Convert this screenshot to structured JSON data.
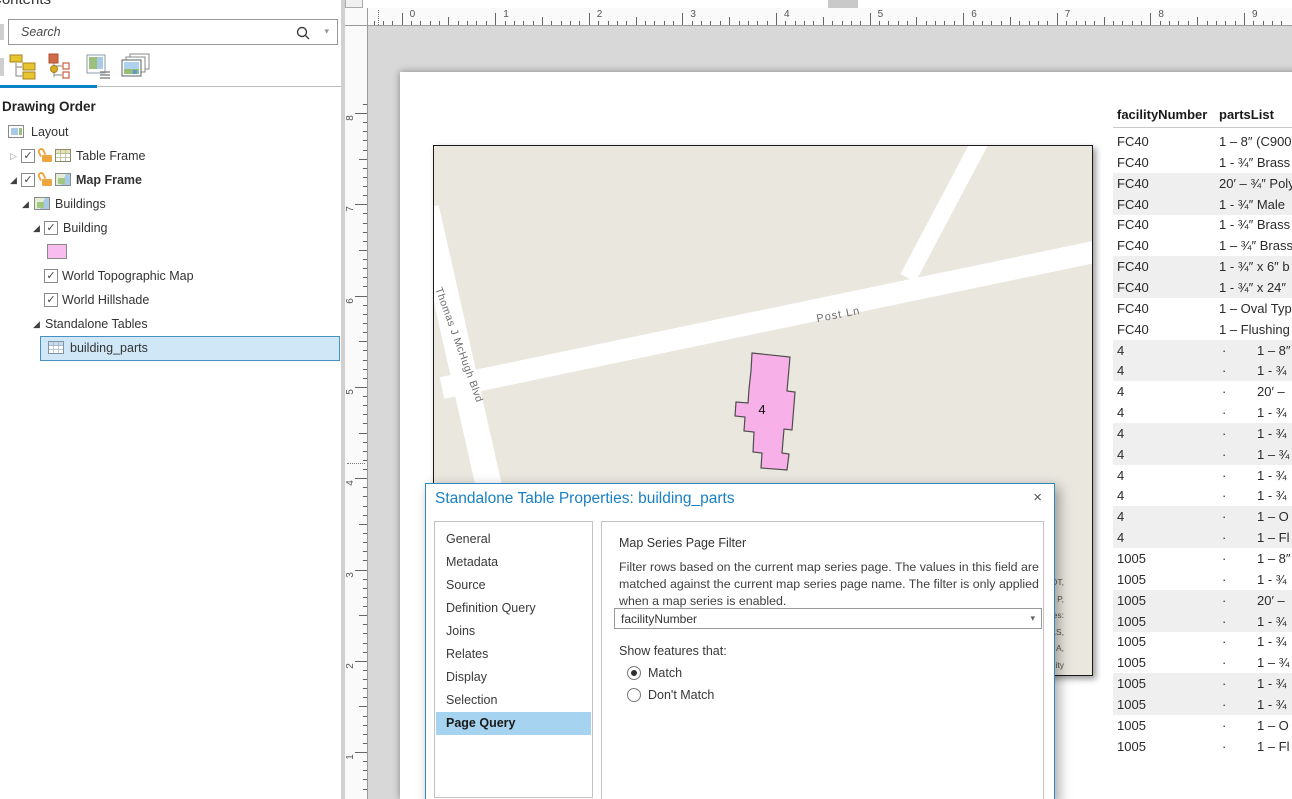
{
  "colors": {
    "accent_blue": "#0b82c8",
    "selection_fill": "#cfe7f7",
    "sidebar_selected": "#a6d3ef",
    "building_pink": "#f8b0e8",
    "swatch_pink": "#f9bcee",
    "map_background": "#e9e7de",
    "row_band": "#efefef"
  },
  "contents_panel": {
    "title": "Contents",
    "search": {
      "placeholder": "Search"
    },
    "section_heading": "Drawing Order",
    "toolbar_icons": [
      "list-by-drawing-order",
      "list-by-source",
      "list-by-selection",
      "list-by-snapping"
    ],
    "tree": [
      {
        "label": "Layout",
        "icon": "layout",
        "xi": 8,
        "xt": 31,
        "y": 121
      },
      {
        "label": "Table Frame",
        "expander": "collapsed",
        "xe": 10,
        "checkbox": true,
        "xc": 21,
        "lock": true,
        "xl": 42,
        "icon": "table-frame",
        "xi": 55,
        "xt": 76,
        "y": 145
      },
      {
        "label": "Map Frame",
        "bold": true,
        "expander": "expanded",
        "xe": 10,
        "checkbox": true,
        "xc": 21,
        "lock": true,
        "xl": 42,
        "icon": "map-frame",
        "xi": 55,
        "xt": 76,
        "y": 169
      },
      {
        "label": "Buildings",
        "expander": "expanded",
        "xe": 22,
        "icon": "map",
        "xi": 34,
        "xt": 55,
        "y": 193
      },
      {
        "label": "Building",
        "expander": "expanded",
        "xe": 33,
        "checkbox": true,
        "xc": 44,
        "xt": 63,
        "y": 217
      },
      {
        "swatch": true,
        "xs": 47,
        "y": 242
      },
      {
        "label": "World Topographic Map",
        "checkbox": true,
        "xc": 44,
        "xt": 62,
        "y": 265
      },
      {
        "label": "World Hillshade",
        "checkbox": true,
        "xc": 44,
        "xt": 62,
        "y": 289
      },
      {
        "label": "Standalone Tables",
        "expander": "expanded",
        "xe": 33,
        "xt": 45,
        "y": 313
      },
      {
        "label": "building_parts",
        "icon": "table",
        "xi": 48,
        "xt": 70,
        "y": 337,
        "selected": true
      }
    ]
  },
  "rulers": {
    "horizontal": [
      "0",
      "1",
      "2",
      "3",
      "4",
      "5",
      "6",
      "7",
      "8",
      "9"
    ],
    "vertical": [
      "8",
      "7",
      "6",
      "5",
      "4",
      "3",
      "2",
      "1"
    ]
  },
  "map": {
    "street_labels": [
      "Thomas J McHugh Blvd",
      "Post Ln"
    ],
    "building_label": "4",
    "attribution_fragments": [
      "OT,",
      "P,",
      "es:",
      "LS,",
      "A,",
      "ity"
    ]
  },
  "dialog": {
    "title": "Standalone Table Properties: building_parts",
    "close_glyph": "×",
    "sidebar_items": [
      "General",
      "Metadata",
      "Source",
      "Definition Query",
      "Joins",
      "Relates",
      "Display",
      "Selection",
      "Page Query"
    ],
    "selected_item": "Page Query",
    "content": {
      "heading": "Map Series Page Filter",
      "description_lines": [
        "Filter rows based on the current map series page. The values in this field are",
        "matched against the current map series page name. The filter is only applied",
        "when a map series is enabled."
      ],
      "dropdown_value": "facilityNumber",
      "dropdown_caret": "▾",
      "show_features_label": "Show features that:",
      "radio_options": [
        {
          "label": "Match",
          "selected": true
        },
        {
          "label": "Don't Match",
          "selected": false
        }
      ]
    }
  },
  "table": {
    "columns": [
      "facilityNumber",
      "partsList"
    ],
    "rows": [
      {
        "facility": "FC40",
        "dot": false,
        "part": "1 – 8″ (C900)"
      },
      {
        "facility": "FC40",
        "dot": false,
        "part": "1 - ¾″ Brass"
      },
      {
        "facility": "FC40",
        "dot": false,
        "part": "20′ – ¾″ Poly"
      },
      {
        "facility": "FC40",
        "dot": false,
        "part": "1 - ¾″ Male"
      },
      {
        "facility": "FC40",
        "dot": false,
        "part": "1 - ¾″ Brass"
      },
      {
        "facility": "FC40",
        "dot": false,
        "part": "1 – ¾″ Brass"
      },
      {
        "facility": "FC40",
        "dot": false,
        "part": "1 - ¾″ x 6″ b"
      },
      {
        "facility": "FC40",
        "dot": false,
        "part": "1 - ¾″ x 24″"
      },
      {
        "facility": "FC40",
        "dot": false,
        "part": "1 – Oval Type"
      },
      {
        "facility": "FC40",
        "dot": false,
        "part": "1 – Flushing"
      },
      {
        "facility": "4",
        "dot": true,
        "part": "1 – 8″"
      },
      {
        "facility": "4",
        "dot": true,
        "part": "1 - ¾"
      },
      {
        "facility": "4",
        "dot": true,
        "part": "20′ –"
      },
      {
        "facility": "4",
        "dot": true,
        "part": "1 - ¾"
      },
      {
        "facility": "4",
        "dot": true,
        "part": "1 - ¾"
      },
      {
        "facility": "4",
        "dot": true,
        "part": "1 – ¾"
      },
      {
        "facility": "4",
        "dot": true,
        "part": "1 - ¾"
      },
      {
        "facility": "4",
        "dot": true,
        "part": "1 - ¾"
      },
      {
        "facility": "4",
        "dot": true,
        "part": "1 – O"
      },
      {
        "facility": "4",
        "dot": true,
        "part": "1 – Fl"
      },
      {
        "facility": "1005",
        "dot": true,
        "part": "1 – 8″"
      },
      {
        "facility": "1005",
        "dot": true,
        "part": "1 - ¾"
      },
      {
        "facility": "1005",
        "dot": true,
        "part": "20′ –"
      },
      {
        "facility": "1005",
        "dot": true,
        "part": "1 - ¾"
      },
      {
        "facility": "1005",
        "dot": true,
        "part": "1 - ¾"
      },
      {
        "facility": "1005",
        "dot": true,
        "part": "1 – ¾"
      },
      {
        "facility": "1005",
        "dot": true,
        "part": "1 - ¾"
      },
      {
        "facility": "1005",
        "dot": true,
        "part": "1 - ¾"
      },
      {
        "facility": "1005",
        "dot": true,
        "part": "1 – O"
      },
      {
        "facility": "1005",
        "dot": true,
        "part": "1 – Fl"
      }
    ]
  }
}
